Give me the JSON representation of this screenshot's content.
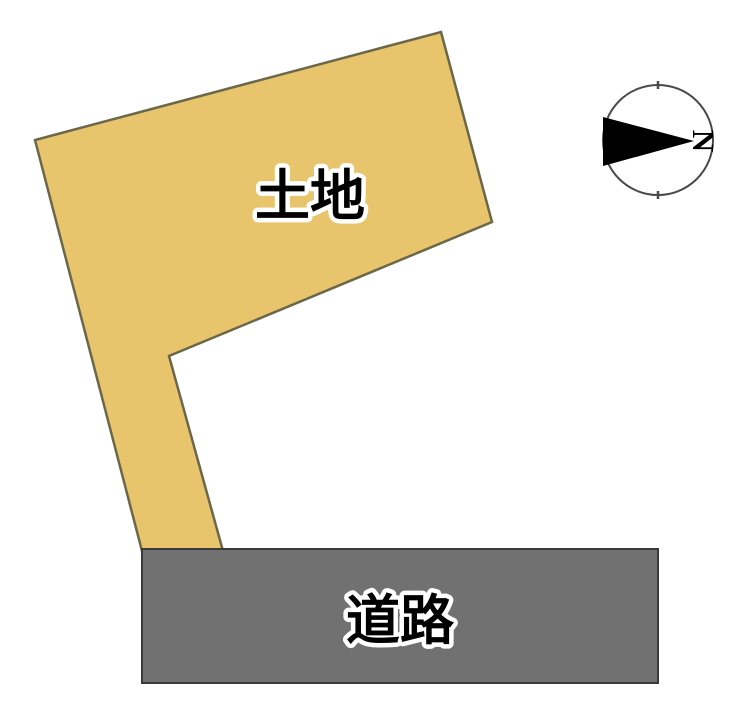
{
  "page": {
    "background": "#ffffff"
  },
  "land": {
    "label": "土地",
    "fill": "#e8c46d",
    "stroke": "#6b6749"
  },
  "road": {
    "label": "道路",
    "fill": "#717171",
    "stroke": "#3a3a3a"
  },
  "labels": {
    "text_color": "#000000",
    "halo_color": "#ffffff"
  },
  "compass": {
    "north_label": "N",
    "circle_stroke": "#4a4a4a",
    "circle_fill": "#ffffff",
    "arrow_fill": "#000000",
    "letter_color": "#000000"
  }
}
